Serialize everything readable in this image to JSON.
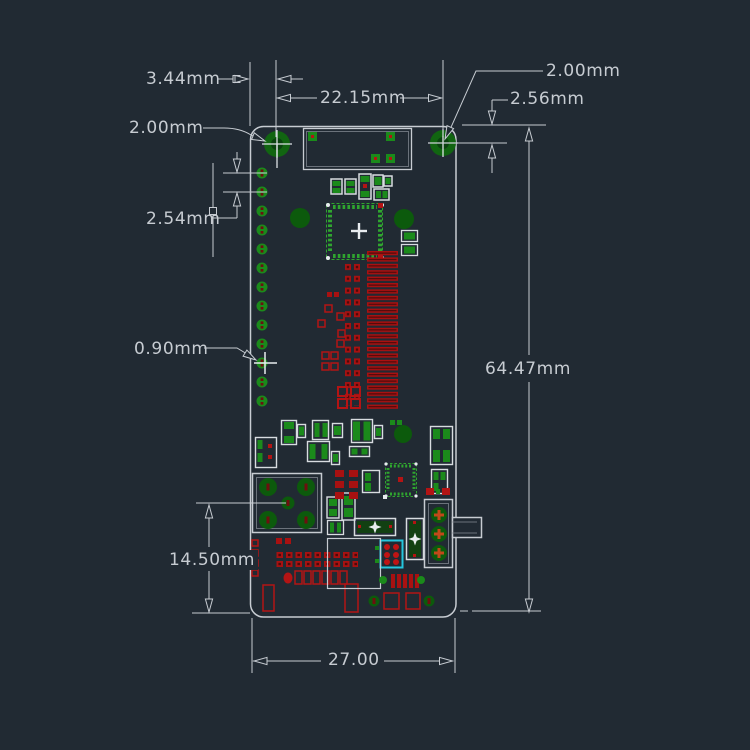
{
  "title": "PCB dimension drawing",
  "canvas": {
    "background": "#212A33"
  },
  "colors": {
    "dimension_line": "#C7CCD2",
    "board_outline": "#C7CCD2",
    "silkscreen_white": "#D8DCE0",
    "pad_green": "#1B8A1B",
    "copper_green_dark": "#0C5A0C",
    "chip_outline_green": "#2FA52F",
    "copper_red": "#B31414",
    "selection_cyan": "#25C6DE",
    "switch_pad_orange": "#C2491A"
  },
  "dimensions": {
    "hole_edge_offset": "3.44mm",
    "hole_spacing": "22.15mm",
    "hole_drill_left": "2.00mm",
    "hole_drill_right": "2.00mm",
    "hole_top_offset": "2.56mm",
    "pin_pitch": "2.54mm",
    "pad_width": "0.90mm",
    "board_height": "64.47mm",
    "usb_bottom_offset": "14.50mm",
    "board_width": "27.00"
  }
}
